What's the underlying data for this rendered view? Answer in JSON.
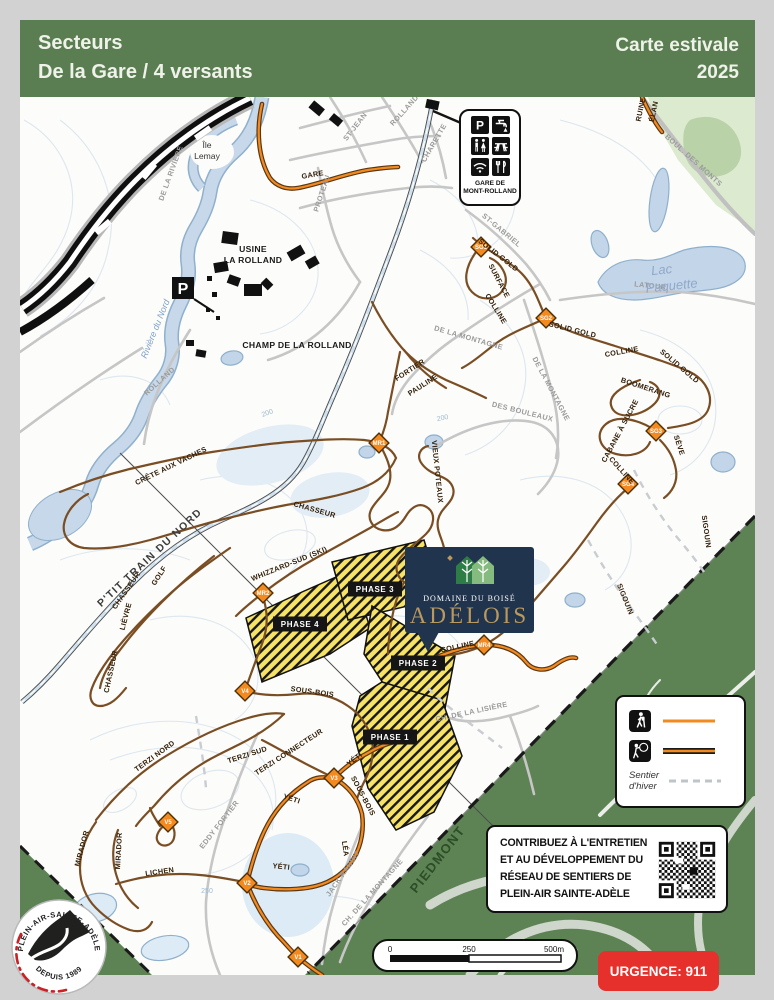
{
  "page": {
    "bg": "#d2d2d2"
  },
  "header": {
    "bg": "#5a7e52",
    "title_line1": "Secteurs",
    "title_line2": "De la Gare / 4 versants",
    "edition_line1": "Carte estivale",
    "edition_line2": "2025"
  },
  "colors": {
    "trail_brown": "#7a4e24",
    "multiuse_orange": "#f28a1f",
    "phase_yellow": "#f5e267",
    "water_blue": "#c6d8ea",
    "sector_green": "#5d8355",
    "emergency_red": "#e5302c",
    "adelois_navy": "#20344d",
    "adelois_gold": "#b9995e"
  },
  "station_box": {
    "name_line1": "GARE DE",
    "name_line2": "MONT-ROLLAND",
    "icons": [
      "parking-icon",
      "water-tap-icon",
      "toilets-icon",
      "picnic-table-icon",
      "wifi-icon",
      "restaurant-icon"
    ]
  },
  "parking": {
    "label": "P"
  },
  "adelois": {
    "line1": "DOMAINE DU BOISÉ",
    "line2": "ADÉLOIS"
  },
  "phases": {
    "p1": "PHASE 1",
    "p2": "PHASE 2",
    "p3": "PHASE 3",
    "p4": "PHASE 4"
  },
  "waypoints": {
    "sg1": "SG1",
    "sg2": "SG2",
    "sg3": "SG3",
    "sg4": "SG4",
    "mr1": "MR1",
    "mr2": "MR2",
    "mr4": "MR4",
    "v1": "V1",
    "v2": "V2",
    "v3": "V3",
    "v4": "V4",
    "v5": "V5"
  },
  "trail_labels": {
    "solid_gold_1": "SOLID GOLD",
    "surface": "SURFACE",
    "colline_1": "COLLINE",
    "solid_gold_2": "SOLID GOLD",
    "colline_2": "COLLINE",
    "solid_gold_3": "SOLID GOLD",
    "boomerang": "BOOMERANG",
    "cabane_a_sucre": "CABANE À SUCRE",
    "seve": "SÈVE",
    "colline_3": "COLLINE",
    "sigouin_1": "SIGOUIN",
    "sigouin_2": "SIGOUIN",
    "colline_4": "COLLINE",
    "crete_aux_vaches": "CRÊTE AUX VACHES",
    "chasseur_1": "CHASSEUR",
    "chasseur_2": "CHASSEUR",
    "chasseur_3": "CHASSEUR",
    "golf": "GOLF",
    "lievre": "LIÈVRE",
    "ptit_train": "P'TIT TRAIN DU NORD",
    "whizzard": "WHIZZARD-SUD (SKI)",
    "fortier": "FORTIER",
    "pauline": "PAULINE",
    "vieux_poteaux": "VIEUX POTEAUX",
    "sous_bois_1": "SOUS-BOIS",
    "sous_bois_2": "SOUS-BOIS",
    "terzi_nord": "TERZI NORD",
    "terzi_sud": "TERZI SUD",
    "terzi_connecteur": "TERZI CONNECTEUR",
    "mirador_1": "MIRADOR",
    "mirador_2": "MIRADOR",
    "lichen": "LICHEN",
    "yeti_1": "YÉTI",
    "yeti_2": "YÉTI",
    "yeti_3": "YÉTI",
    "lea": "LÉA",
    "elan": "ÉLAN",
    "ruine": "RUINE",
    "gare_trail": "GARE"
  },
  "road_labels": {
    "boul_des_monts": "BOUL. DES MONTS",
    "latour": "LATOUR",
    "st_gabriel": "ST-GABRIEL",
    "de_la_montagne_1": "DE LA MONTAGNE",
    "de_la_montagne_2": "DE LA MONTAGNE",
    "des_bouleaux": "DES BOULEAUX",
    "st_jean": "ST-JEAN",
    "rolland_1": "ROLLAND",
    "charette": "CHARETTE",
    "proteau": "PROTEAU",
    "rolland_2": "ROLLAND",
    "de_la_riviere": "DE LA RIVIÈRE",
    "eddy_fortier": "EDDY FORTIER",
    "jack_rabbit": "JACK RABBIT",
    "ch_montagne": "CH. DE LA MONTAGNE",
    "ch_lisiere": "CH. DE LA LISIÈRE"
  },
  "water_labels": {
    "lac_line1": "Lac",
    "lac_line2": "Paquette",
    "riviere": "Rivière du Nord"
  },
  "place_labels": {
    "ile_line1": "Île",
    "ile_line2": "Lemay",
    "usine_line1": "USINE",
    "usine_line2": "LA ROLLAND",
    "champ": "CHAMP DE LA ROLLAND",
    "piedmont": "PIEDMONT"
  },
  "contour_labels": {
    "c200a": "200",
    "c200b": "200",
    "c250": "250"
  },
  "legend": {
    "row1_icon": "hiker-icon",
    "row2_icon": "hiker-bike-icon",
    "winter_line1": "Sentier",
    "winter_line2": "d'hiver"
  },
  "contribute": {
    "line1": "CONTRIBUEZ À L'ENTRETIEN",
    "line2": "ET AU DÉVELOPPEMENT DU",
    "line3": "RÉSEAU DE SENTIERS DE",
    "line4": "PLEIN-AIR SAINTE-ADÈLE"
  },
  "scalebar": {
    "t0": "0",
    "t250": "250",
    "t500": "500m"
  },
  "emergency": {
    "label": "URGENCE: 911"
  },
  "org": {
    "arc": "PLEIN-AIR-SAINTE-ADÈLE",
    "since": "DEPUIS 1989"
  }
}
